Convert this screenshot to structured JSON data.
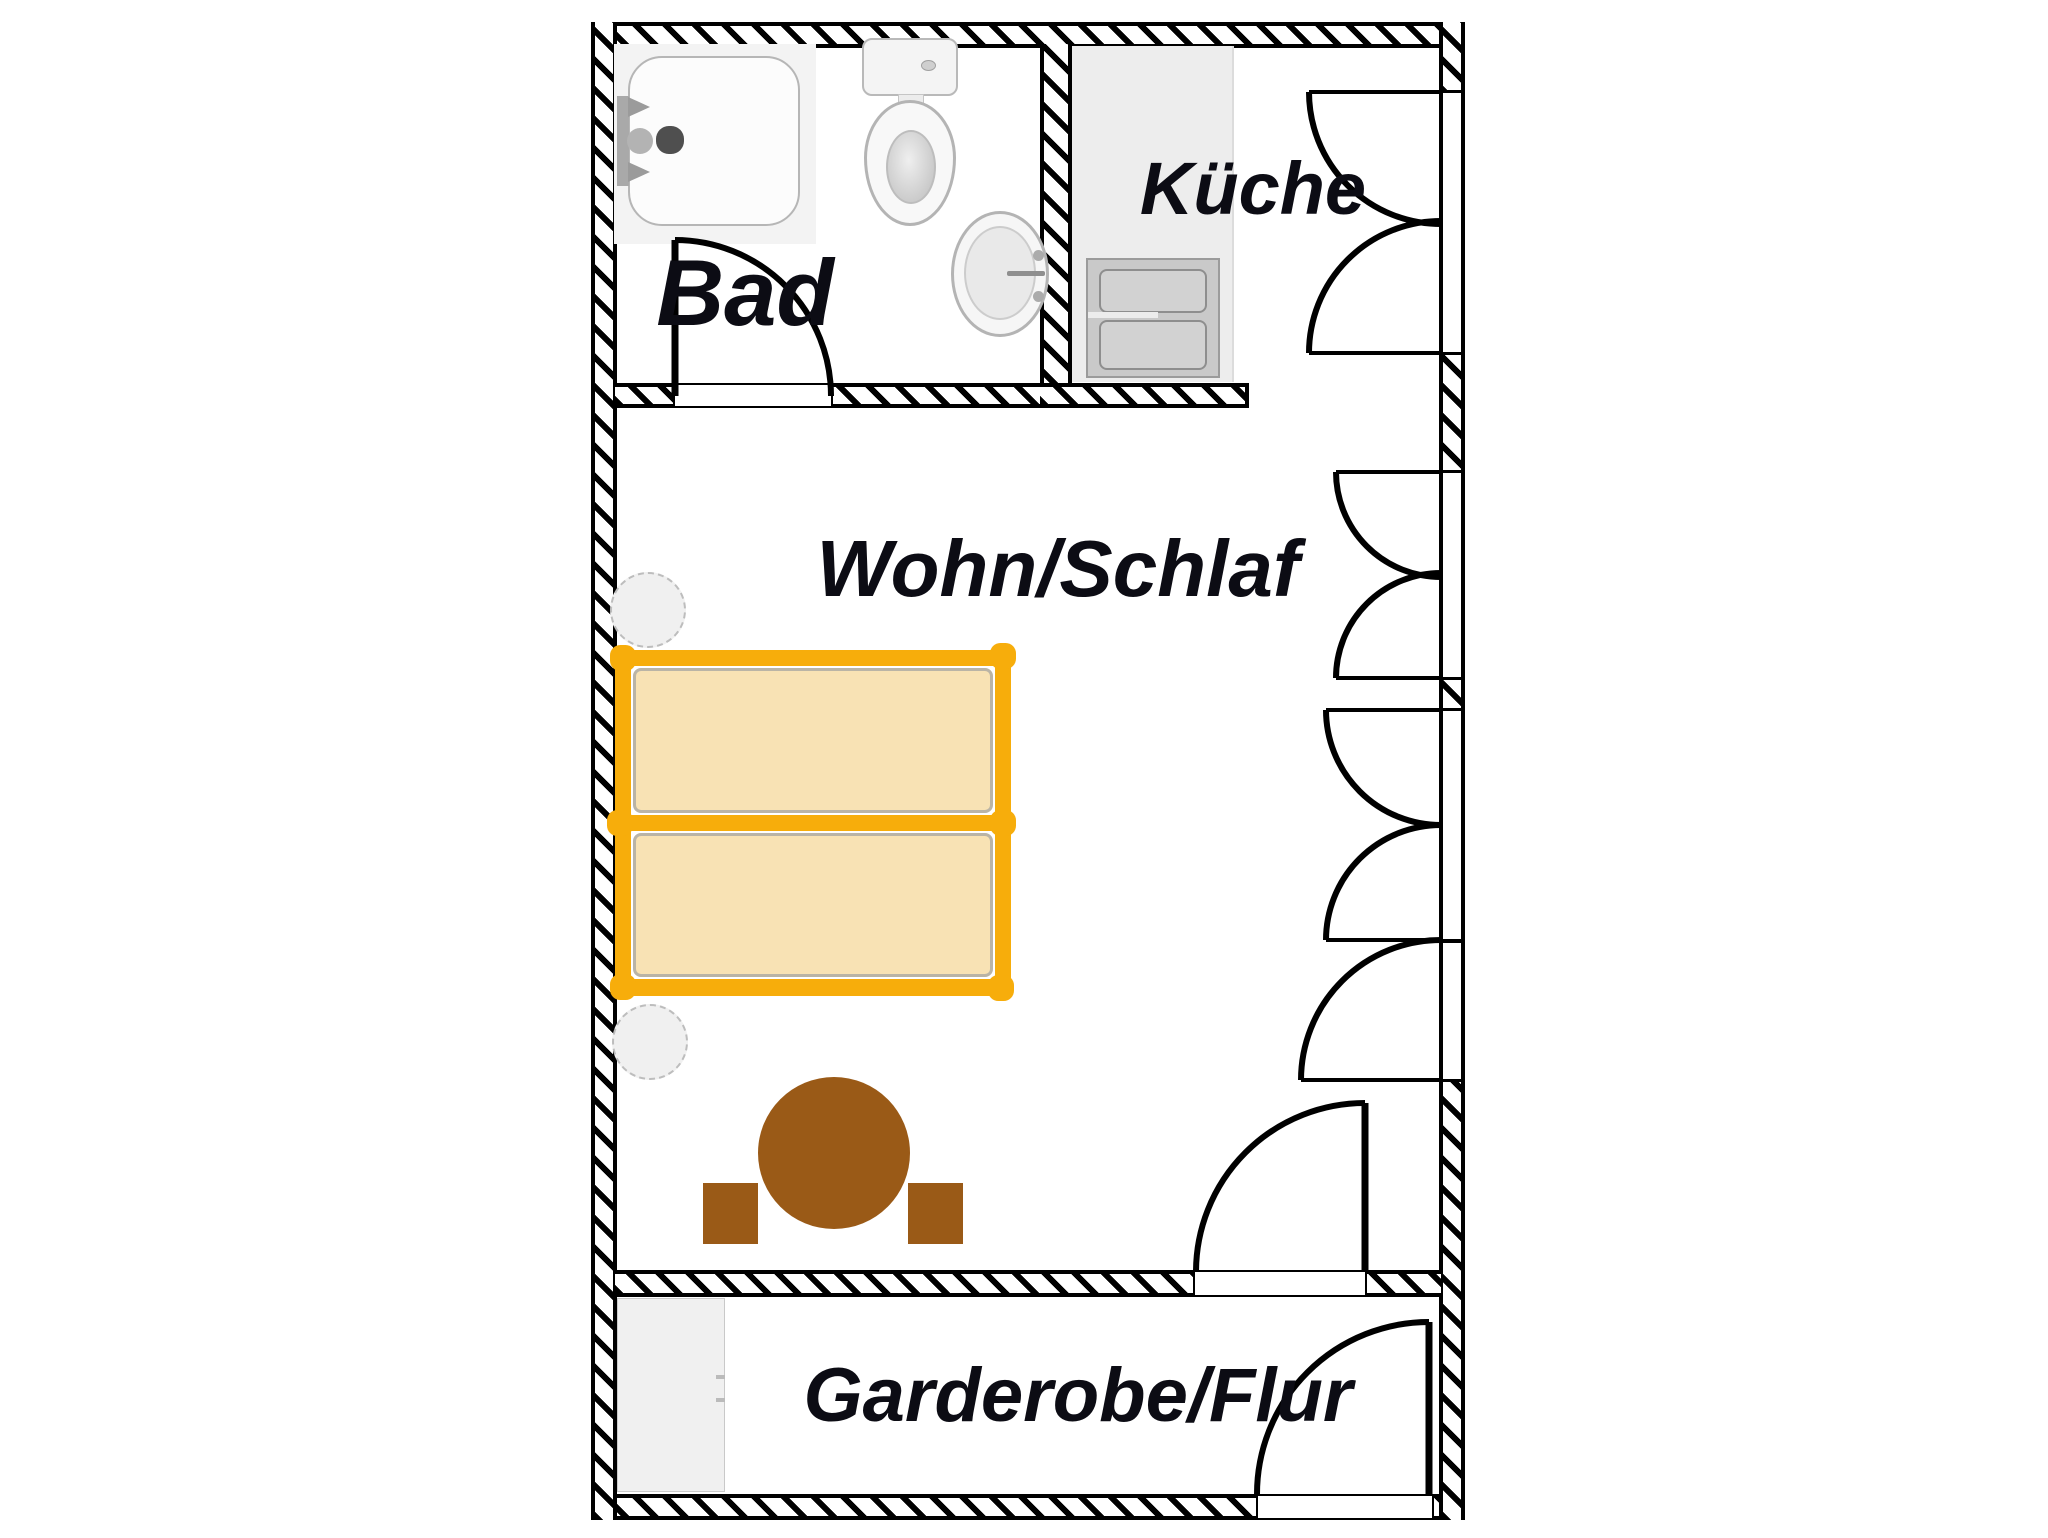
{
  "plan": {
    "type": "apartment-floor-plan",
    "rooms": [
      {
        "id": "bad",
        "label": "Bad"
      },
      {
        "id": "kueche",
        "label": "Küche"
      },
      {
        "id": "wohn_schlaf",
        "label": "Wohn/Schlaf"
      },
      {
        "id": "garderobe_flur",
        "label": "Garderobe/Flur"
      }
    ],
    "fixtures": [
      "shower",
      "toilet",
      "sink",
      "kitchen-counter",
      "stove",
      "bed-upper",
      "bed-lower",
      "bedside-stool-upper",
      "bedside-stool-lower",
      "round-table",
      "stool-left",
      "stool-right",
      "wardrobe"
    ],
    "windows": {
      "count": 4,
      "location": "right wall",
      "style": "double-casement arcs, lowest single-casement"
    },
    "doors": [
      {
        "id": "bad-door",
        "between": [
          "bad",
          "wohn_schlaf"
        ]
      },
      {
        "id": "wohn-garderobe-door",
        "between": [
          "wohn_schlaf",
          "garderobe_flur"
        ]
      },
      {
        "id": "entry-door",
        "between": [
          "garderobe_flur",
          "outside"
        ]
      }
    ],
    "colors": {
      "wall": "#000000",
      "bed_frame_orange": "#F7AD0B",
      "mattress_tan": "#F8E2B4",
      "table_brown": "#9A5A17",
      "fixture_gray": "#EDEDED",
      "label_text": "#0C0C14"
    }
  }
}
